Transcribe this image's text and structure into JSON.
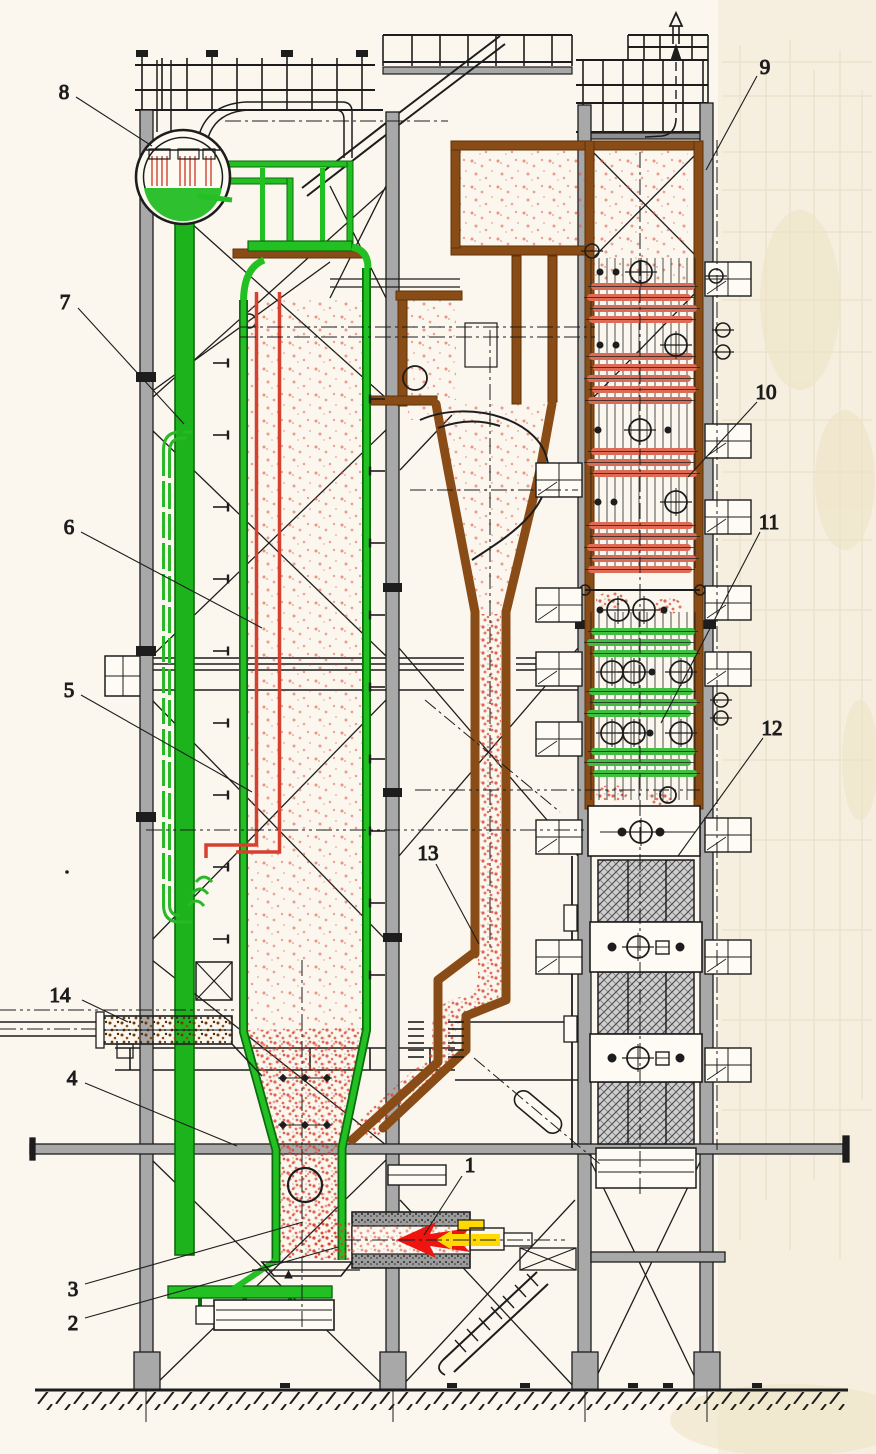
{
  "diagram": {
    "kind": "sectional engineering drawing",
    "subject": "circulating fluidized bed boiler",
    "callouts": [
      {
        "number": "1",
        "part": "startup-burner"
      },
      {
        "number": "2",
        "part": "air-distributor"
      },
      {
        "number": "3",
        "part": "fluidized-bed"
      },
      {
        "number": "4",
        "part": "furnace-hopper"
      },
      {
        "number": "5",
        "part": "water-wall"
      },
      {
        "number": "6",
        "part": "furnace"
      },
      {
        "number": "7",
        "part": "downcomer"
      },
      {
        "number": "8",
        "part": "steam-drum"
      },
      {
        "number": "9",
        "part": "backpass-enclosure"
      },
      {
        "number": "10",
        "part": "superheater"
      },
      {
        "number": "11",
        "part": "economizer"
      },
      {
        "number": "12",
        "part": "air-preheater"
      },
      {
        "number": "13",
        "part": "cyclone-dipleg"
      },
      {
        "number": "14",
        "part": "coal-feeder"
      }
    ],
    "colors": {
      "background": "#fbf7ee",
      "paper_margin": "#f6efdf",
      "line": "#1d1d1d",
      "steel_gray": "#a8a8a8",
      "water_green": "#22c022",
      "dark_green": "#0c6b0c",
      "refractory_brown": "#8a4c16",
      "hot_gas_red": "#e0503a",
      "tube_red": "#de6b55",
      "tube_green": "#41bf41",
      "flame_red": "#ee1410",
      "fuel_yellow": "#ffd900"
    }
  }
}
